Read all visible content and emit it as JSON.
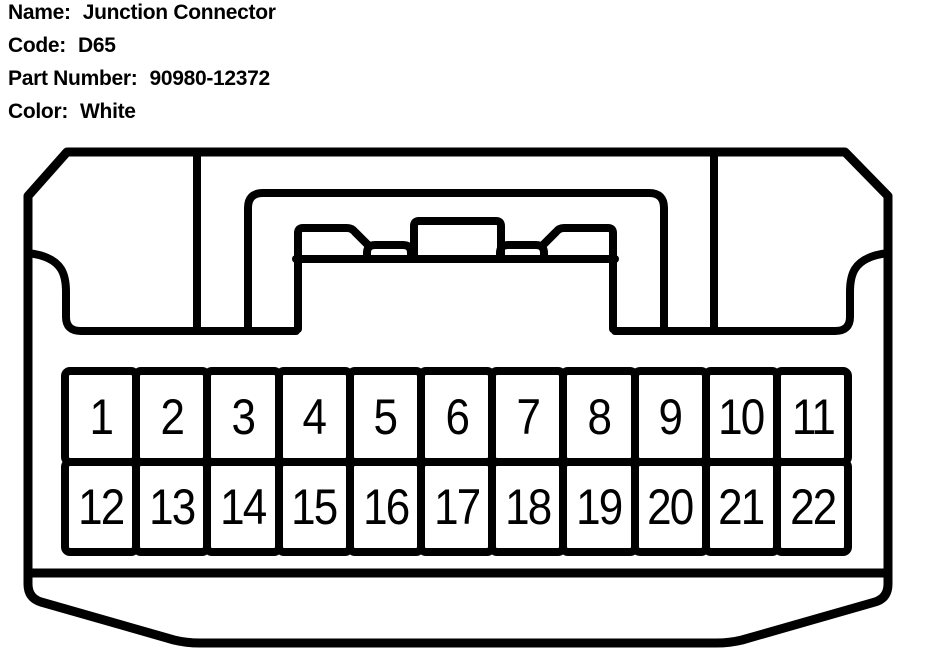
{
  "page": {
    "background_color": "#ffffff",
    "line_color": "#000000"
  },
  "header": {
    "fields": [
      {
        "label": "Name:",
        "value": "Junction Connector"
      },
      {
        "label": "Code:",
        "value": "D65"
      },
      {
        "label": "Part Number:",
        "value": "90980-12372"
      },
      {
        "label": "Color:",
        "value": "White"
      }
    ]
  },
  "connector": {
    "view": "22-pin junction connector, mating face view, 2 rows",
    "pin_count": 22,
    "rows": [
      {
        "pins": [
          "1",
          "2",
          "3",
          "4",
          "5",
          "6",
          "7",
          "8",
          "9",
          "10",
          "11"
        ]
      },
      {
        "pins": [
          "12",
          "13",
          "14",
          "15",
          "16",
          "17",
          "18",
          "19",
          "20",
          "21",
          "22"
        ]
      }
    ]
  }
}
